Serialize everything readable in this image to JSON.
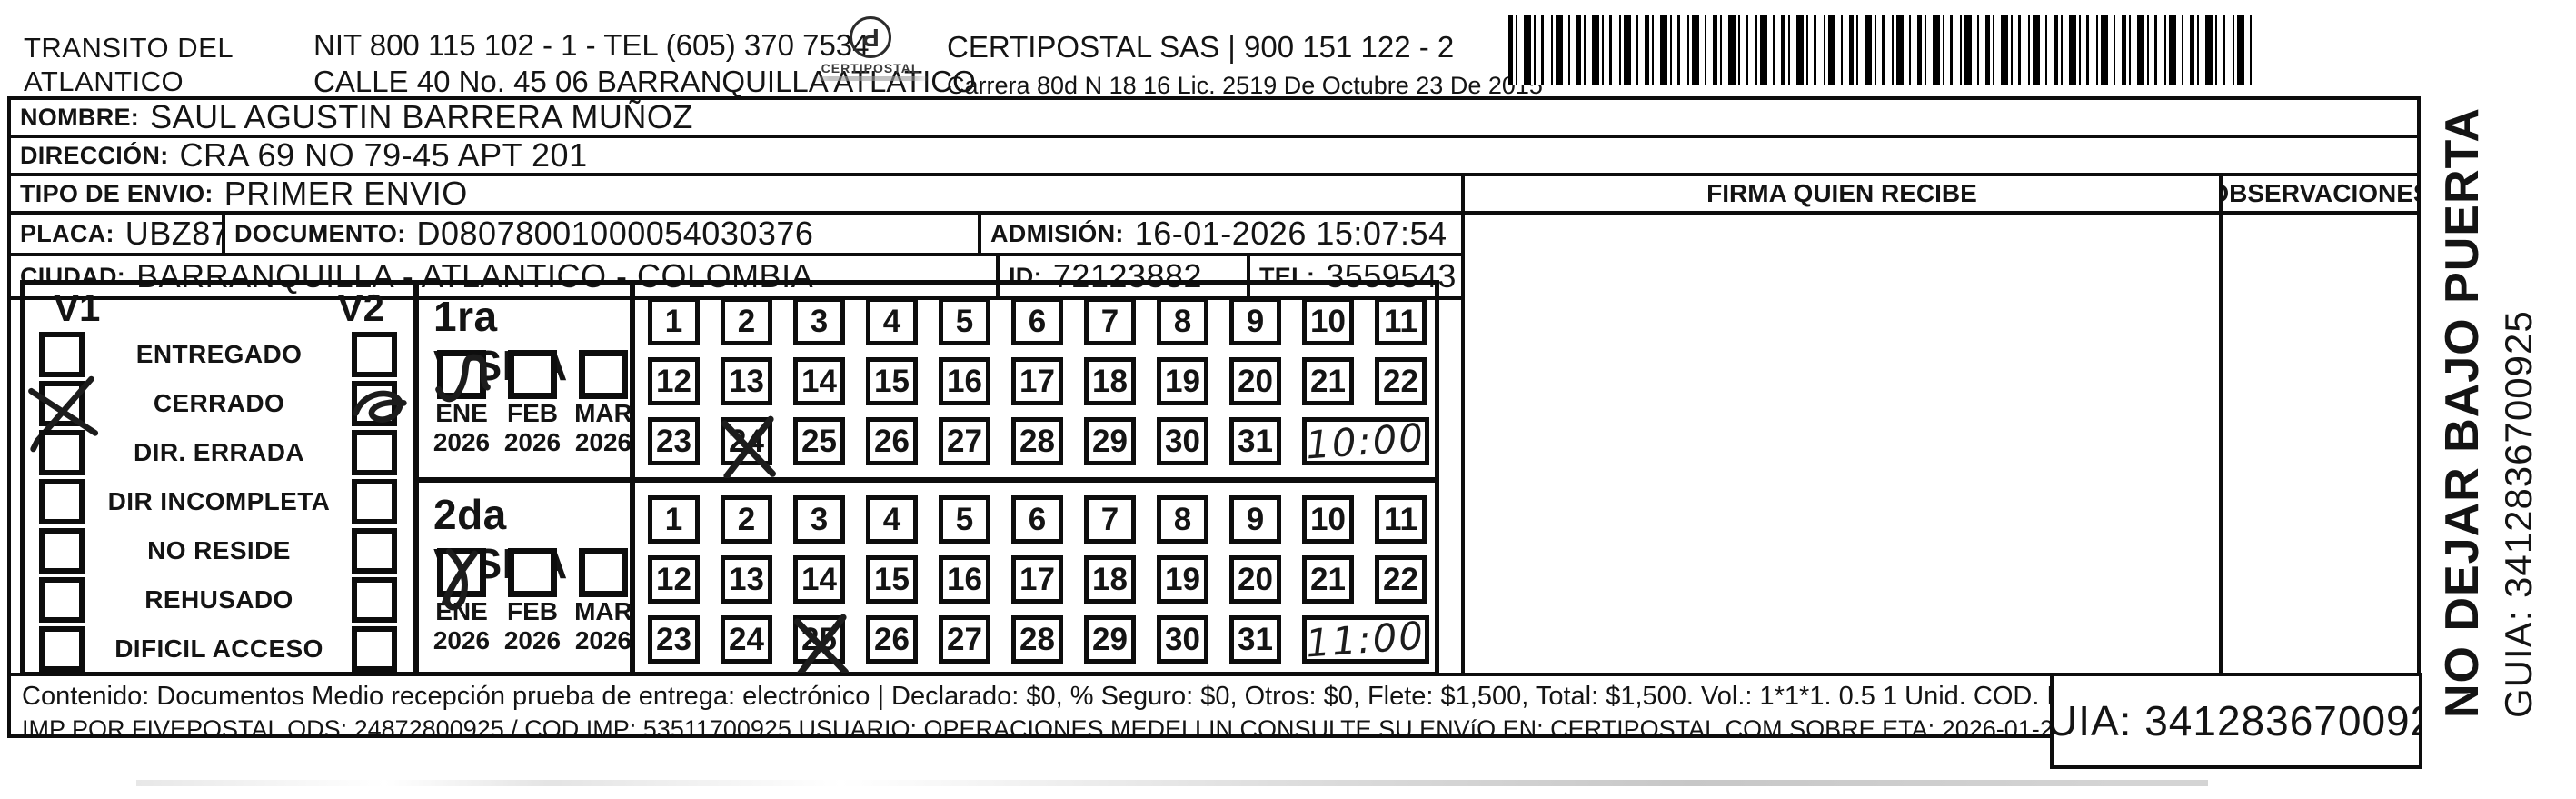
{
  "header": {
    "sender_line1": "TRANSITO DEL",
    "sender_line2": "ATLANTICO",
    "nit_line": "NIT 800 115 102 - 1 - TEL (605) 370 7534",
    "address_line": "CALLE 40 No. 45 06 BARRANQUILLA ATLATICO",
    "logo_name": "CERTIPOSTAL",
    "company_line": "CERTIPOSTAL SAS | 900 151 122 - 2",
    "license_line": "Carrera 80d N 18 16  Lic. 2519 De Octubre 23 De 2015"
  },
  "fields": {
    "nombre_label": "NOMBRE:",
    "nombre_value": "SAUL AGUSTIN BARRERA MUÑOZ",
    "direccion_label": "DIRECCIÓN:",
    "direccion_value": "CRA 69 NO 79-45 APT 201",
    "tipo_envio_label": "TIPO DE ENVIO:",
    "tipo_envio_value": "PRIMER ENVIO",
    "placa_label": "PLACA:",
    "placa_value": "UBZ871",
    "documento_label": "DOCUMENTO:",
    "documento_value": "D08078001000054030376",
    "admision_label": "ADMISIÓN:",
    "admision_value": "16-01-2026 15:07:54",
    "ciudad_label": "CIUDAD:",
    "ciudad_value": "BARRANQUILLA - ATLANTICO - COLOMBIA",
    "id_label": "ID:",
    "id_value": "72123882",
    "tel_label": "TEL:",
    "tel_value": "3559543"
  },
  "columns": {
    "firma": "FIRMA QUIEN RECIBE",
    "observaciones": "OBSERVACIONES"
  },
  "status": {
    "v1_header": "V1",
    "v2_header": "V2",
    "options": [
      {
        "label": "ENTREGADO",
        "v1_mark": null,
        "v2_mark": null
      },
      {
        "label": "CERRADO",
        "v1_mark": "big-x",
        "v2_mark": "loop"
      },
      {
        "label": "DIR. ERRADA",
        "v1_mark": null,
        "v2_mark": null
      },
      {
        "label": "DIR INCOMPLETA",
        "v1_mark": null,
        "v2_mark": null
      },
      {
        "label": "NO RESIDE",
        "v1_mark": null,
        "v2_mark": null
      },
      {
        "label": "REHUSADO",
        "v1_mark": null,
        "v2_mark": null
      },
      {
        "label": "DIFICIL ACCESO",
        "v1_mark": null,
        "v2_mark": null
      }
    ]
  },
  "visits": [
    {
      "title": "1ra VISITA",
      "months": [
        {
          "month": "ENE",
          "year": "2026",
          "mark": "check-loop"
        },
        {
          "month": "FEB",
          "year": "2026",
          "mark": null
        },
        {
          "month": "MAR",
          "year": "2026",
          "mark": null
        }
      ],
      "days": [
        1,
        2,
        3,
        4,
        5,
        6,
        7,
        8,
        9,
        10,
        11,
        12,
        13,
        14,
        15,
        16,
        17,
        18,
        19,
        20,
        21,
        22,
        23,
        24,
        25,
        26,
        27,
        28,
        29,
        30,
        31
      ],
      "crossed_day": 24,
      "handwritten_time": "10:00"
    },
    {
      "title": "2da VISITA",
      "months": [
        {
          "month": "ENE",
          "year": "2026",
          "mark": "x-loop"
        },
        {
          "month": "FEB",
          "year": "2026",
          "mark": null
        },
        {
          "month": "MAR",
          "year": "2026",
          "mark": null
        }
      ],
      "days": [
        1,
        2,
        3,
        4,
        5,
        6,
        7,
        8,
        9,
        10,
        11,
        12,
        13,
        14,
        15,
        16,
        17,
        18,
        19,
        20,
        21,
        22,
        23,
        24,
        25,
        26,
        27,
        28,
        29,
        30,
        31
      ],
      "crossed_day": 25,
      "handwritten_time": "11:00"
    }
  ],
  "side_note": {
    "warning": "NO DEJAR BAJO PUERTA",
    "guia": "GUIA: 3412836700925"
  },
  "footer": {
    "content_line": "Contenido: Documentos Medio recepción prueba de entrega: electrónico | Declarado: $0, % Seguro: $0, Otros: $0, Flete: $1,500, Total: $1,500. Vol.: 1*1*1. 0.5  1 Unid. COD. POSTAL: 080001",
    "fine_print": "IMP POR FIVEPOSTAL ODS: 24872800925 / COD IMP: 53511700925 USUARIO: OPERACIONES MEDELLIN CONSULTE SU ENVíO EN: CERTIPOSTAL.COM SOBRE ETA: 2026-01-20 D+2",
    "guia_box": "GUIA: 3412836700925"
  }
}
